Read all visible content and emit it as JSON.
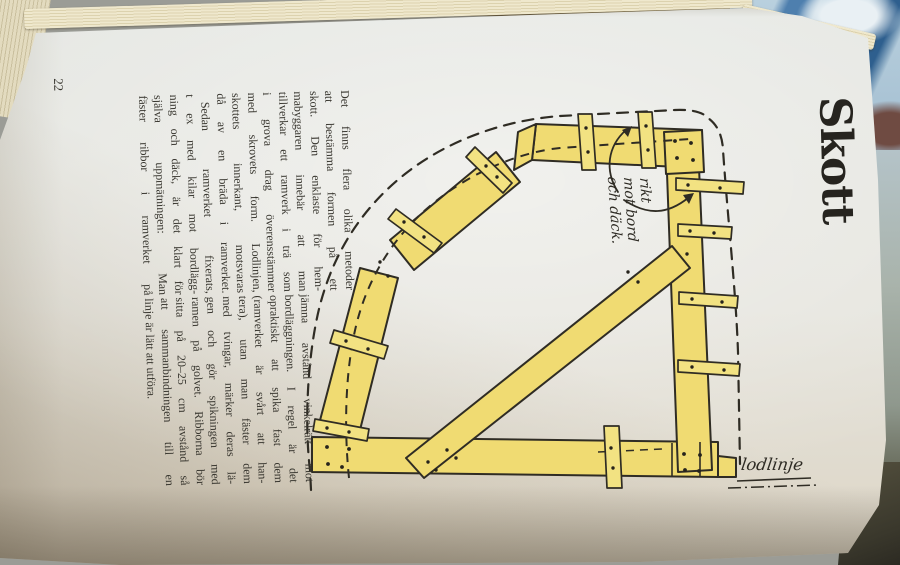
{
  "photo": {
    "description": "photograph of an open book page, rotated 90 degrees",
    "page_number": "22",
    "title": "Skott",
    "columns": {
      "col1": [
        "Det finns flera olika metoder",
        "att bestämma formen på ett",
        "skott. Den enklaste för hem-",
        "mabyggaren innebär att man",
        "tillverkar ett ramverk i trä som",
        "i grova drag överensstämmer",
        "med skrovets form. Lodlinjen,",
        "skottets innerkant, motsvaras",
        "då av en bräda i ramverket.",
        "Sedan ramverket fixerats,",
        "t ex med kilar mot bordlägg-",
        "ning och däck, är det klart för",
        "själva uppmätningen: Man",
        "fäster ribbor i ramverket på"
      ],
      "col2": [
        "jämna avstånd vinkelrätt mot",
        "bordläggningen. I regel är det",
        "opraktiskt att spika fast dem",
        "(ramverket är svårt att han-",
        "tera), utan man fäster dem",
        "med tvingar, märker deras lä-",
        "gen och gör spikningen med",
        "ramen på golvet. Ribborna bör",
        "sitta på 20–25 cm avstånd så",
        "att sammanbindningen till en",
        "linje är lätt att utföra."
      ]
    },
    "annotations": {
      "rib_note_lines": [
        "rikt",
        "mot bord",
        "och däck."
      ],
      "plumb_line_label": "lodlinje"
    },
    "illustration": {
      "subject": "wooden bulkhead template frame with battens, diagonal brace, dashed hull outline and plumb line",
      "colors": {
        "plank_yellow": "#f0db72",
        "rib_yellow": "#f2e282",
        "ink": "#2f2c24",
        "paper": "#e5e7e3"
      }
    }
  }
}
